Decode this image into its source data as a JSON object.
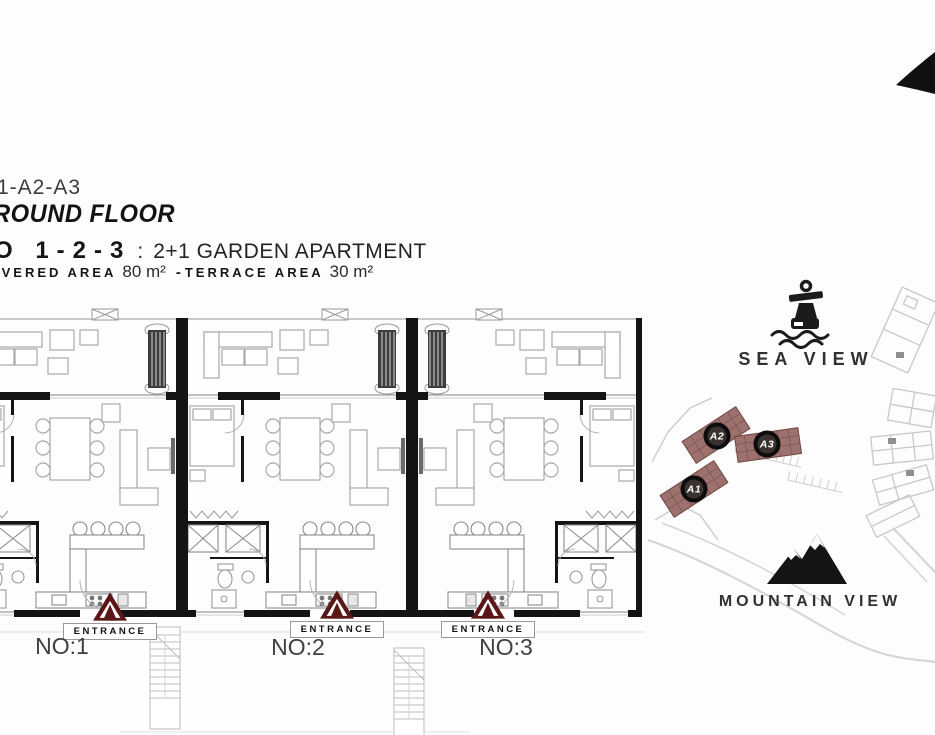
{
  "header": {
    "project_line": "1-A2-A3",
    "floor_line": "ROUND FLOOR",
    "units_line": {
      "no": "O 1-2-3",
      "colon": ":",
      "desc": "2+1 GARDEN APARTMENT"
    },
    "area_line": {
      "covered_label": "IVERED AREA",
      "covered_value": "80 m²",
      "separator": "-",
      "terrace_label": "TERRACE AREA",
      "terrace_value": "30 m²"
    }
  },
  "floorplan": {
    "units": [
      {
        "number_label": "NO:1",
        "entrance_label": "ENTRANCE"
      },
      {
        "number_label": "NO:2",
        "entrance_label": "ENTRANCE"
      },
      {
        "number_label": "NO:3",
        "entrance_label": "ENTRANCE"
      }
    ]
  },
  "siteplan": {
    "markers": [
      {
        "label": "A1"
      },
      {
        "label": "A2"
      },
      {
        "label": "A3"
      }
    ]
  },
  "views": {
    "sea": "SEA VIEW",
    "mountain": "MOUNTAIN VIEW"
  },
  "colors": {
    "entrance_marker": "#5b1717",
    "highlight_building": "#9d716d",
    "wall": "#141414",
    "furniture_line": "#a8a8a8",
    "site_outline": "#c8c8c8"
  }
}
